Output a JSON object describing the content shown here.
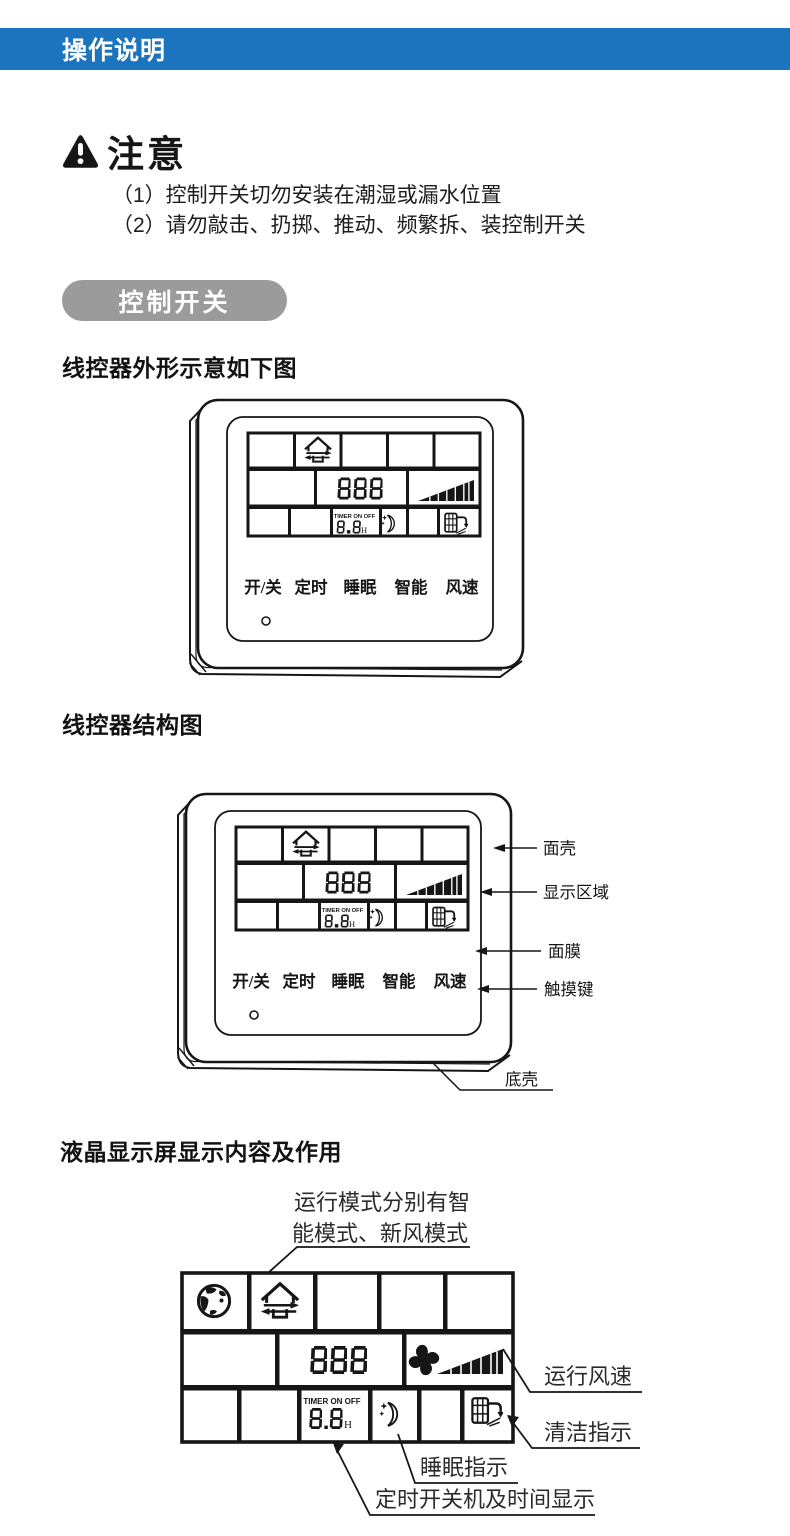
{
  "header": {
    "title": "操作说明",
    "bg_color": "#1b74bd"
  },
  "notice": {
    "title": "注意",
    "items": [
      "（1）控制开关切勿安装在潮湿或漏水位置",
      "（2）请勿敲击、扔掷、推动、频繁拆、装控制开关"
    ]
  },
  "pill": {
    "label": "控制开关",
    "bg_color": "#9b9b9b"
  },
  "headings": {
    "outline": "线控器外形示意如下图",
    "structure": "线控器结构图",
    "lcd": "液晶显示屏显示内容及作用"
  },
  "controller": {
    "buttons": [
      "开/关",
      "定时",
      "睡眠",
      "智能",
      "风速"
    ],
    "lcd": {
      "digits": "888",
      "timer_label": "TIMER ON OFF",
      "timer_digits": "8.8",
      "timer_unit": "H"
    }
  },
  "structure_labels": {
    "face_shell": "面壳",
    "display_area": "显示区域",
    "membrane": "面膜",
    "touch_keys": "触摸键",
    "bottom_shell": "底壳"
  },
  "lcd_annotations": {
    "mode_line1": "运行模式分别有智",
    "mode_line2": "能模式、新风模式",
    "fan_speed": "运行风速",
    "clean": "清洁指示",
    "sleep": "睡眠指示",
    "timer": "定时开关机及时间显示"
  },
  "icons": {
    "warning": "warning-triangle-icon",
    "globe": "globe-mode-icon",
    "house": "fresh-air-house-icon",
    "fan": "fan-blade-icon",
    "speed_ramp": "fan-speed-ramp-icon",
    "moon": "sleep-moon-icon",
    "clean": "filter-clean-icon"
  }
}
